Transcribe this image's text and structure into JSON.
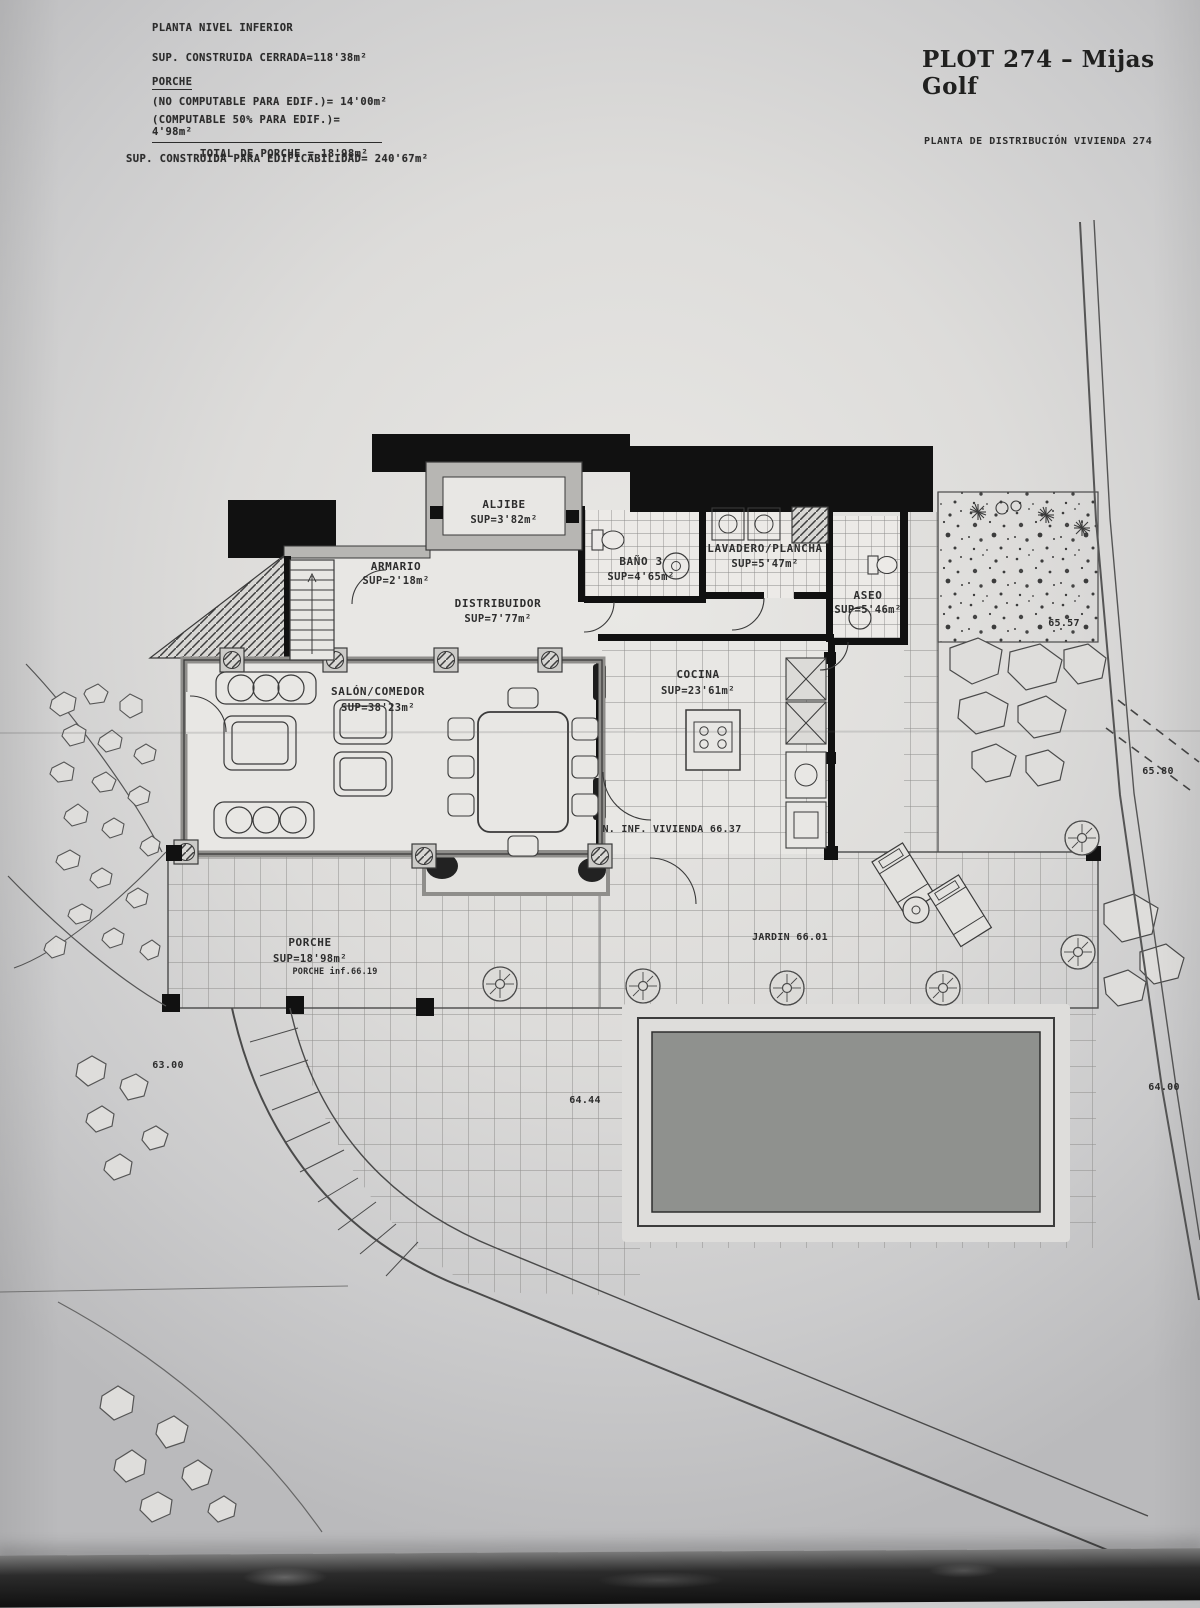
{
  "header": {
    "plan_label": "PLANTA NIVEL INFERIOR",
    "sup_cerrada": "SUP. CONSTRUIDA CERRADA=118'38m²",
    "porche_heading": "PORCHE",
    "porche_no_computable": "(NO COMPUTABLE PARA EDIF.)= 14'00m²",
    "porche_computable": "(COMPUTABLE 50% PARA EDIF.)= 4'98m²",
    "porche_total": "TOTAL DE PORCHE = 18'98m²",
    "sup_edificabilidad": "SUP. CONSTRUIDA PARA EDIFICABILIDAD= 240'67m²",
    "title": "PLOT 274 – Mijas Golf",
    "subtitle": "PLANTA DE DISTRIBUCIÓN VIVIENDA 274"
  },
  "rooms": {
    "aljibe": {
      "name": "ALJIBE",
      "area": "SUP=3'82m²"
    },
    "armario": {
      "name": "ARMARIO",
      "area": "SUP=2'18m²"
    },
    "distribuidor": {
      "name": "DISTRIBUIDOR",
      "area": "SUP=7'77m²"
    },
    "bano3": {
      "name": "BAÑO 3",
      "area": "SUP=4'65m²"
    },
    "lavadero": {
      "name": "LAVADERO/PLANCHA",
      "area": "SUP=5'47m²"
    },
    "aseo": {
      "name": "ASEO",
      "area": "SUP=5'46m²"
    },
    "salon": {
      "name": "SALÓN/COMEDOR",
      "area": "SUP=38'23m²"
    },
    "cocina": {
      "name": "COCINA",
      "area": "SUP=23'61m²"
    },
    "porche": {
      "name": "PORCHE",
      "area": "SUP=18'98m²"
    }
  },
  "levels": {
    "vivienda": "N. INF. VIVIENDA 66.37",
    "jardin": "JARDIN 66.01",
    "porche_inf": "PORCHE inf.66.19",
    "garden_left": "63.00",
    "terrace": "64.44",
    "road_low": "64.00",
    "bed_top": "65.57",
    "road_mid": "65.80"
  },
  "colors": {
    "ink": "#2d2d2d",
    "wall_black": "#111111",
    "wall_gray": "#b7b6b3",
    "pool_water": "#8f918e",
    "paper": "#dedddb"
  }
}
